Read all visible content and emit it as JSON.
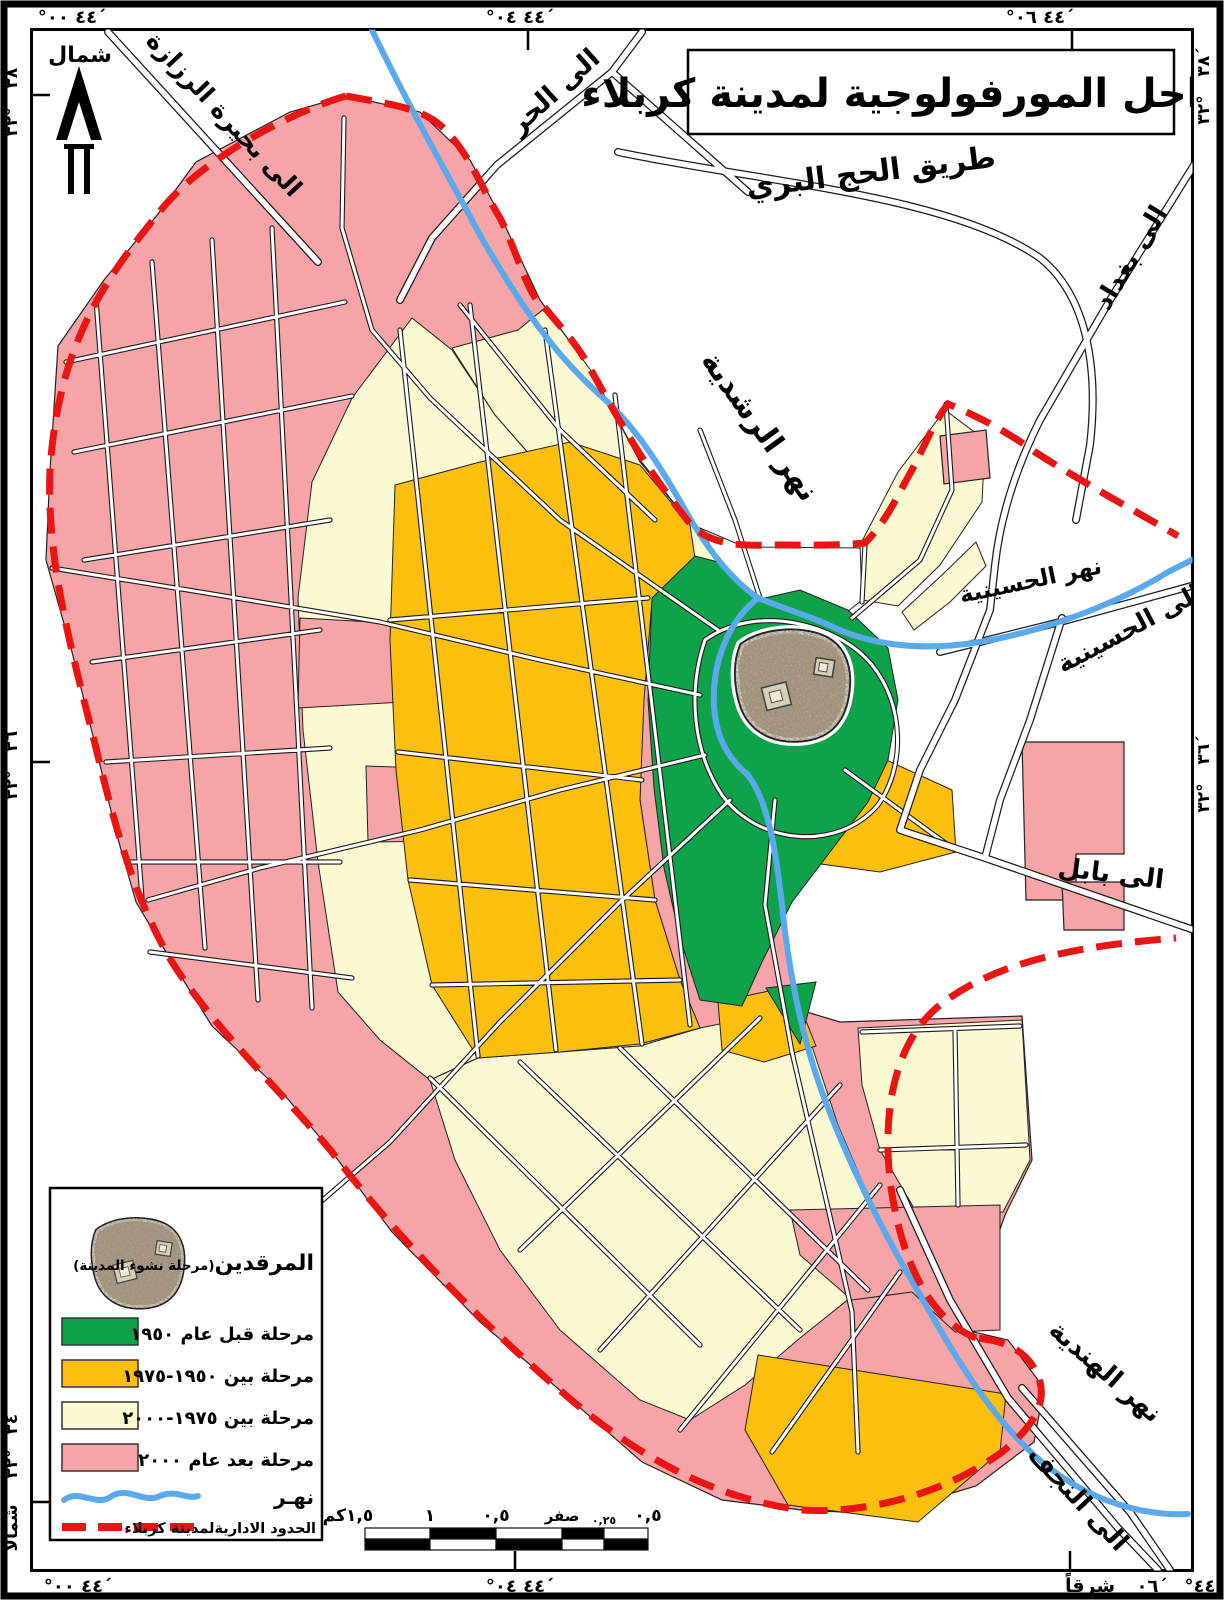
{
  "title": "المراحل المورفولوجية لمدينة كربلاء",
  "north_label": "شمال",
  "colors": {
    "green": "#0EA24B",
    "orange": "#FCBF0E",
    "cream": "#FAF9D2",
    "pink": "#F6A4A8",
    "river": "#5AA9EC",
    "boundary": "#EA1412"
  },
  "labels": {
    "to_hurr": "الى الحر",
    "hajj_road": "طريق الحج البري",
    "to_baghdad": "الى بغداد",
    "to_razzaza": "الى بحيرة الرزازة",
    "rashdiya_river": "نهر الرشدية",
    "husseiniya_river": "نهر الحسينية",
    "to_husseiniya": "الى الحسينية",
    "to_babylon": "الى بابل",
    "hindiya_river": "نهر الهندية",
    "to_najaf": "الى النجف"
  },
  "legend": {
    "shrines_label": "المرقدين",
    "shrines_sublabel": "(مرحلة نشوء المدينة)",
    "items": [
      {
        "label": "مرحلة قبل عام ١٩٥٠",
        "color": "#0EA24B"
      },
      {
        "label": "مرحلة بين ١٩٥٠-١٩٧٥",
        "color": "#FCBF0E"
      },
      {
        "label": "مرحلة بين ١٩٧٥-٢٠٠٠",
        "color": "#FAF9D2"
      },
      {
        "label": "مرحلة بعد عام ٢٠٠٠",
        "color": "#F6A4A8"
      }
    ],
    "river_label": "نهـر",
    "boundary_label": "الحدود الاداريةلمدينة كربلاء"
  },
  "scale_bar": {
    "unit_labels": [
      "١,٥كم",
      "١",
      "٠,٥",
      "صفر",
      "٠,٢٥",
      "٠,٥"
    ]
  },
  "graticule": {
    "top": [
      "°٤٤  ٠٠´",
      "°٤٤  ٠٤´",
      "°٤٤  ٠٦´"
    ],
    "bottom_left": "°٤٤  ٠٠´",
    "bottom_mid": "°٤٤  ٠٤´",
    "bottom_right_east": "شرقاً",
    "bottom_right_min": "٠٦´",
    "bottom_right_deg": "°٤٤",
    "left_top_min": "٣٨´",
    "left_top_deg": "٣٢°",
    "left_mid_min": "٣٦´",
    "left_mid_deg": "٣٢°",
    "left_bot_min": "٣٤´",
    "left_bot_deg": "٣٢°",
    "left_bot_north": "شمالاً",
    "right_top_min": "٣٨´",
    "right_top_deg": "٣٢°",
    "right_mid_min": "٣٦´",
    "right_mid_deg": "٣٢°"
  }
}
